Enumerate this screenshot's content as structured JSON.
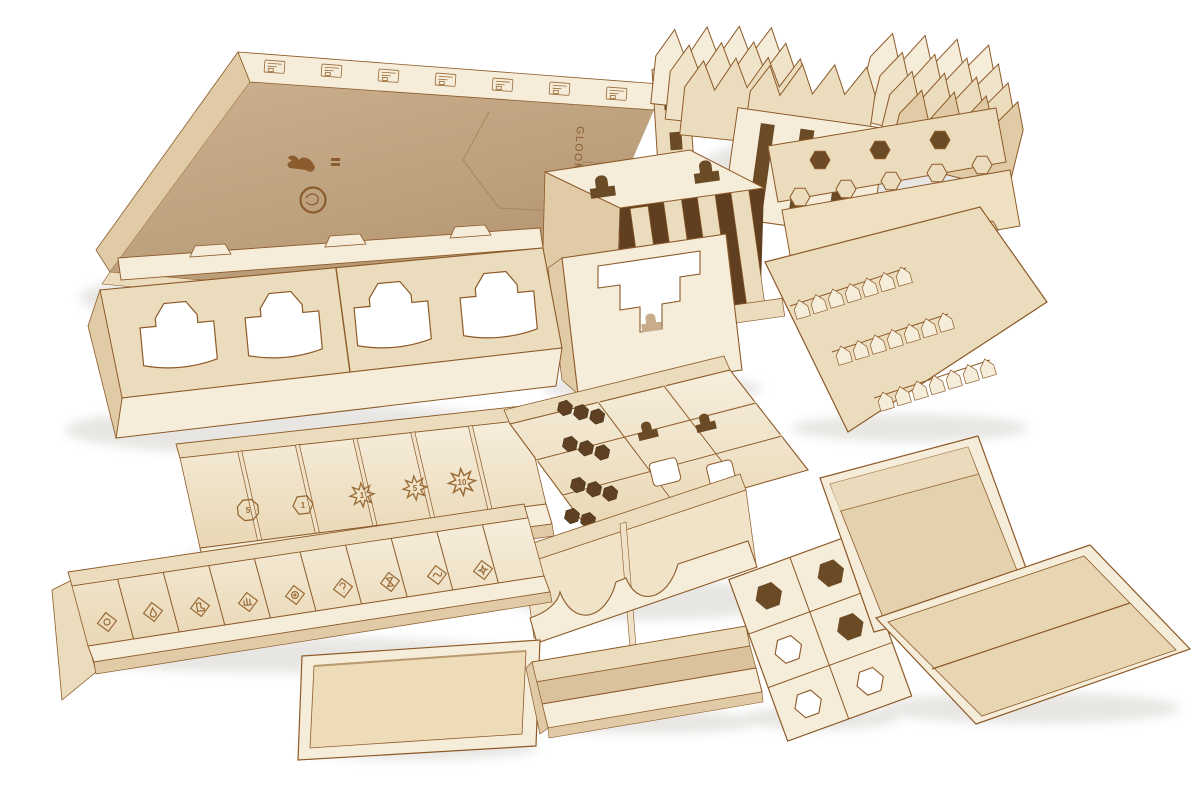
{
  "photo": {
    "subject": "Laser-cut plywood board game box organizer set, unboxed components arranged on white background",
    "background_color": "#ffffff",
    "engraved_text": {
      "box_side": "GLOOMHAVEN"
    },
    "logos": [
      "dragon-figure-logo",
      "round-seal-logo"
    ],
    "palette": {
      "wood_light": "#f5ecda",
      "wood_mid": "#ecdcbe",
      "wood_shade": "#d8c29c",
      "board_tan": "#c7ab89",
      "burn_edge": "#8d5a28",
      "burn_dark": "#6e4018",
      "engraving": "#9a6a35",
      "shadow": "#8f8678"
    },
    "value_dividers": [
      {
        "icon": "octagon-token-icon",
        "value": "5"
      },
      {
        "icon": "hexagon-token-icon",
        "value": "1"
      },
      {
        "icon": "starburst-token-icon",
        "value": "1"
      },
      {
        "icon": "starburst-token-icon",
        "value": "5"
      },
      {
        "icon": "starburst-token-icon",
        "value": "10"
      }
    ],
    "condition_compartments": [
      "target",
      "poison",
      "footprint",
      "wound-hand",
      "stun",
      "question-mark",
      "hourglass",
      "wave",
      "burst"
    ],
    "components": [
      "game-box-lid",
      "card-tuckbox-stack-left",
      "card-tuckbox-stack-mid",
      "card-tuckbox-stack-right",
      "hex-tile-tray-stack",
      "monster-sleeve-comb-tray",
      "slotted-card-box",
      "stepped-card-box",
      "map-tile-rack",
      "value-divider-tray",
      "condition-token-tray",
      "main-organizer-tray",
      "scooped-card-tray",
      "hex-cutout-box",
      "small-flat-tray",
      "long-parts-tray",
      "flat-lid-tray-1",
      "flat-lid-tray-2"
    ]
  }
}
